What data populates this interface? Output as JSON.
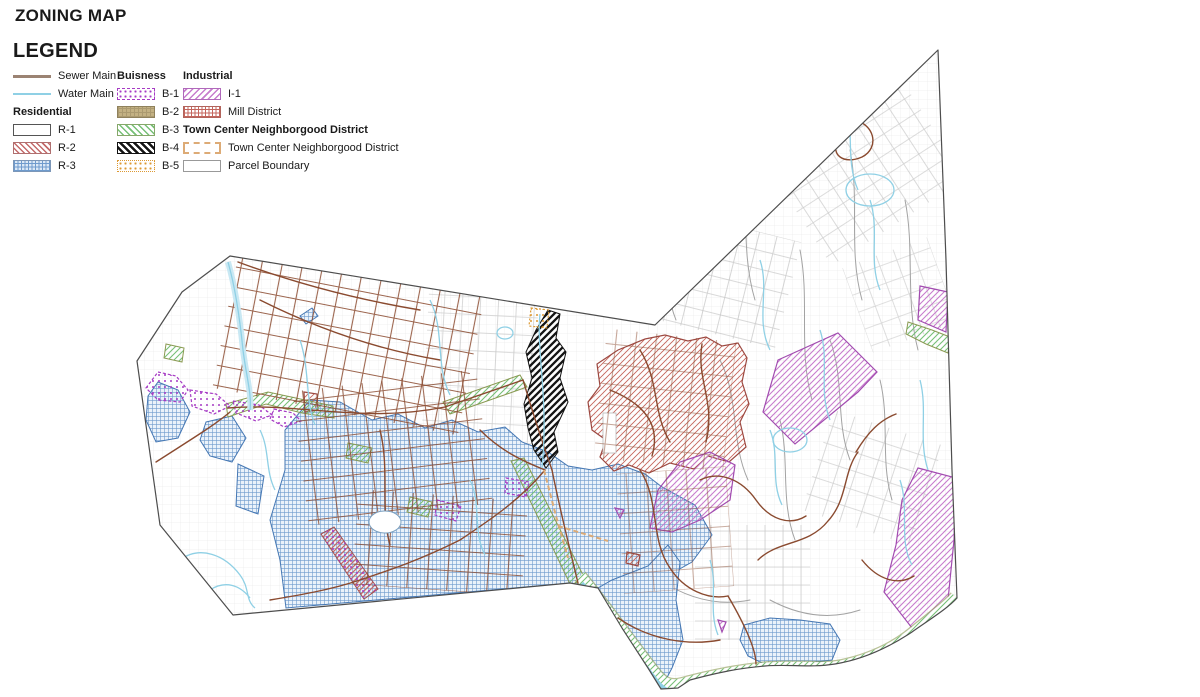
{
  "title": "ZONING MAP",
  "legend": {
    "heading": "LEGEND",
    "lines": [
      {
        "label": "Sewer Main"
      },
      {
        "label": "Water Main"
      }
    ],
    "residential": {
      "header": "Residential",
      "items": [
        {
          "label": "R-1"
        },
        {
          "label": "R-2"
        },
        {
          "label": "R-3"
        }
      ]
    },
    "business": {
      "header": "Buisness",
      "items": [
        {
          "label": "B-1"
        },
        {
          "label": "B-2"
        },
        {
          "label": "B-3"
        },
        {
          "label": "B-4"
        },
        {
          "label": "B-5"
        }
      ]
    },
    "industrial": {
      "header": "Industrial",
      "items": [
        {
          "label": "I-1"
        },
        {
          "label": "Mill District"
        }
      ]
    },
    "town_center": {
      "header": "Town Center Neighborgood District",
      "items": [
        {
          "label": "Town Center Neighborgood District"
        },
        {
          "label": "Parcel Boundary"
        }
      ]
    }
  },
  "map": {
    "colors": {
      "sewer": "#9b8373",
      "sewerRoad": "#8a4a2f",
      "water": "#8fd0e5",
      "boundary": "#4d4d4d",
      "parcel": "#c7c7c7",
      "grayRoad": "#a3a3a3",
      "r2": "#c46a6a",
      "r3": "#6f9bcd",
      "b1": "#a63bc4",
      "b2": "#c3b183",
      "b3": "#76c076",
      "b4": "#141414",
      "b5": "#dd9933",
      "i1": "#c77ccd",
      "mill": "#c4655c",
      "tc": "#ddab76"
    }
  }
}
